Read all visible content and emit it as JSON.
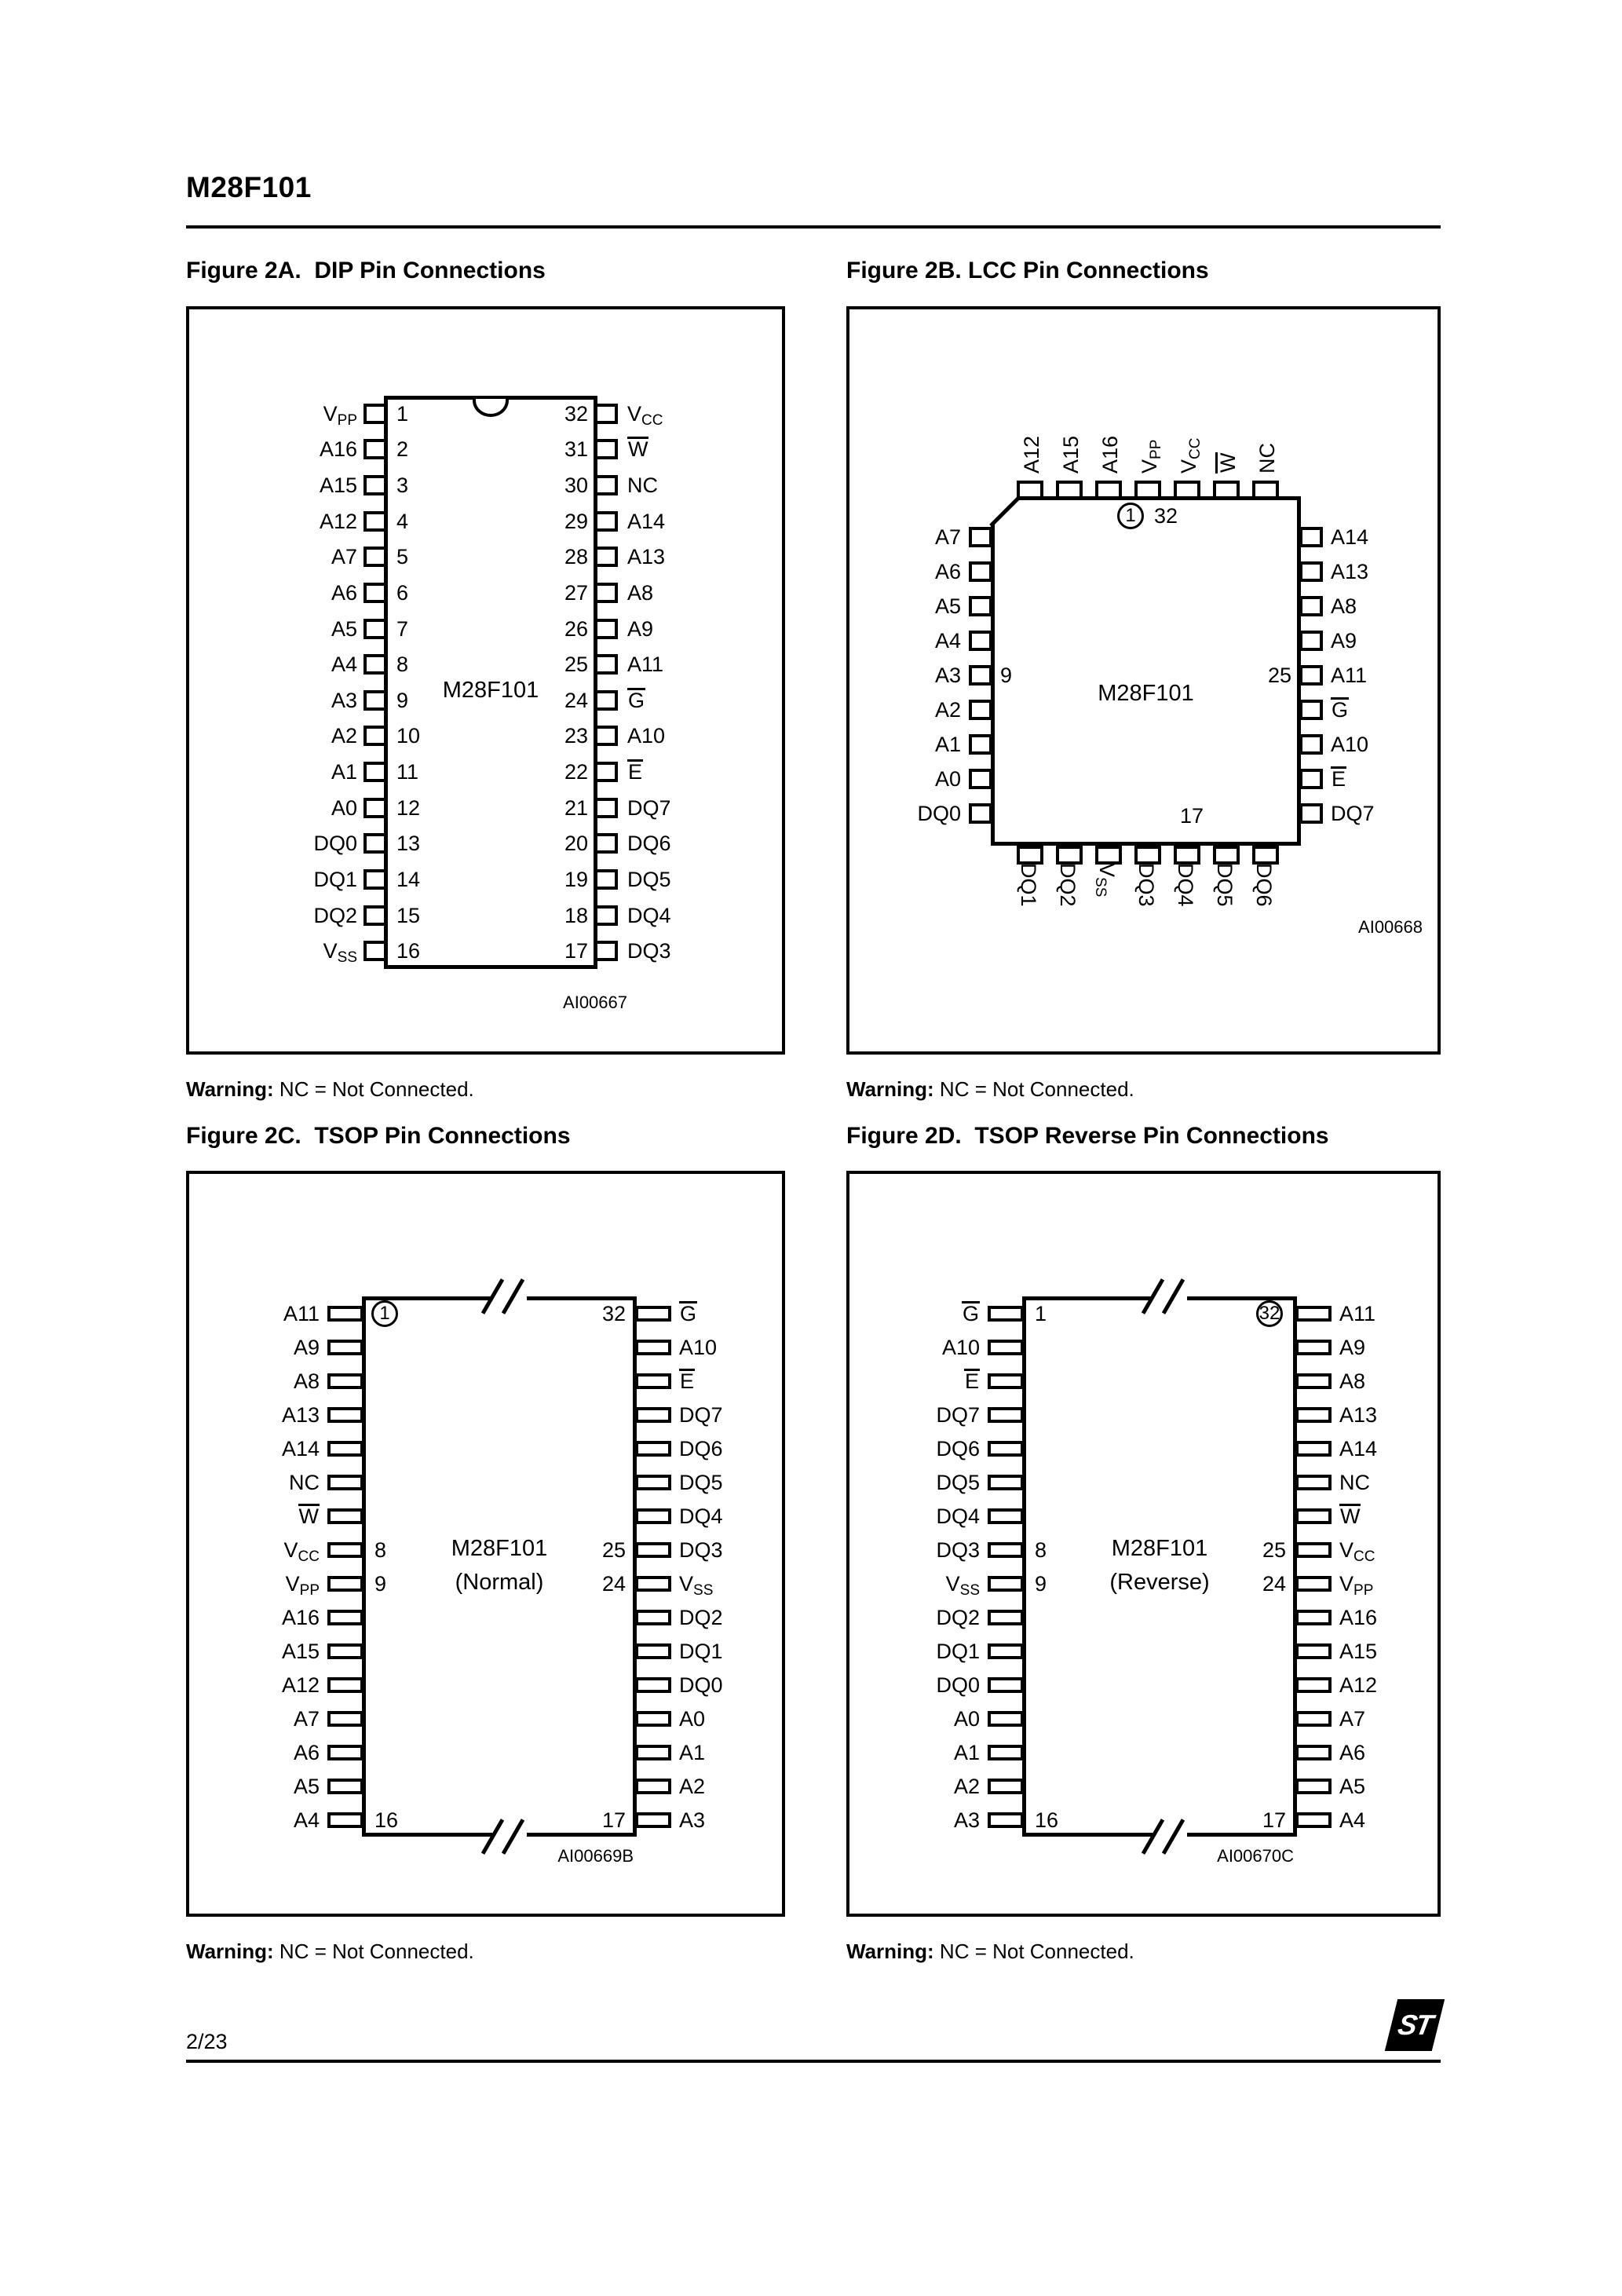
{
  "page": {
    "header_title": "M28F101",
    "page_number": "2/23",
    "logo_text": "ST"
  },
  "warning": {
    "label": "Warning:",
    "text": " NC = Not Connected."
  },
  "figures": {
    "dip": {
      "title": "Figure 2A.  DIP Pin Connections",
      "chip_name": "M28F101",
      "ref": "AI00667",
      "left": [
        {
          "b": "V",
          "s": "PP",
          "n": "1"
        },
        {
          "b": "A16",
          "n": "2"
        },
        {
          "b": "A15",
          "n": "3"
        },
        {
          "b": "A12",
          "n": "4"
        },
        {
          "b": "A7",
          "n": "5"
        },
        {
          "b": "A6",
          "n": "6"
        },
        {
          "b": "A5",
          "n": "7"
        },
        {
          "b": "A4",
          "n": "8"
        },
        {
          "b": "A3",
          "n": "9"
        },
        {
          "b": "A2",
          "n": "10"
        },
        {
          "b": "A1",
          "n": "11"
        },
        {
          "b": "A0",
          "n": "12"
        },
        {
          "b": "DQ0",
          "n": "13"
        },
        {
          "b": "DQ1",
          "n": "14"
        },
        {
          "b": "DQ2",
          "n": "15"
        },
        {
          "b": "V",
          "s": "SS",
          "n": "16"
        }
      ],
      "right": [
        {
          "b": "V",
          "s": "CC",
          "n": "32"
        },
        {
          "b": "W",
          "bar": true,
          "n": "31"
        },
        {
          "b": "NC",
          "n": "30"
        },
        {
          "b": "A14",
          "n": "29"
        },
        {
          "b": "A13",
          "n": "28"
        },
        {
          "b": "A8",
          "n": "27"
        },
        {
          "b": "A9",
          "n": "26"
        },
        {
          "b": "A11",
          "n": "25"
        },
        {
          "b": "G",
          "bar": true,
          "n": "24"
        },
        {
          "b": "A10",
          "n": "23"
        },
        {
          "b": "E",
          "bar": true,
          "n": "22"
        },
        {
          "b": "DQ7",
          "n": "21"
        },
        {
          "b": "DQ6",
          "n": "20"
        },
        {
          "b": "DQ5",
          "n": "19"
        },
        {
          "b": "DQ4",
          "n": "18"
        },
        {
          "b": "DQ3",
          "n": "17"
        }
      ]
    },
    "lcc": {
      "title": "Figure 2B. LCC Pin Connections",
      "chip_name": "M28F101",
      "ref": "AI00668",
      "top": [
        {
          "b": "A12"
        },
        {
          "b": "A15"
        },
        {
          "b": "A16"
        },
        {
          "b": "V",
          "s": "PP"
        },
        {
          "b": "V",
          "s": "CC"
        },
        {
          "b": "W",
          "bar": true
        },
        {
          "b": "NC"
        }
      ],
      "left": [
        {
          "b": "A7"
        },
        {
          "b": "A6"
        },
        {
          "b": "A5"
        },
        {
          "b": "A4"
        },
        {
          "b": "A3"
        },
        {
          "b": "A2"
        },
        {
          "b": "A1"
        },
        {
          "b": "A0"
        },
        {
          "b": "DQ0"
        }
      ],
      "right": [
        {
          "b": "A14"
        },
        {
          "b": "A13"
        },
        {
          "b": "A8"
        },
        {
          "b": "A9"
        },
        {
          "b": "A11"
        },
        {
          "b": "G",
          "bar": true
        },
        {
          "b": "A10"
        },
        {
          "b": "E",
          "bar": true
        },
        {
          "b": "DQ7"
        }
      ],
      "bottom": [
        {
          "b": "DQ1"
        },
        {
          "b": "DQ2"
        },
        {
          "b": "V",
          "s": "SS"
        },
        {
          "b": "DQ3"
        },
        {
          "b": "DQ4"
        },
        {
          "b": "DQ5"
        },
        {
          "b": "DQ6"
        }
      ],
      "pin1_marker": "1",
      "pin32_label": "32",
      "left_inner_num": {
        "text": "9",
        "row": 4
      },
      "right_inner_num": {
        "text": "25",
        "row": 4
      },
      "bottom_inner_num": "17"
    },
    "tsop": {
      "title": "Figure 2C.  TSOP Pin Connections",
      "chip_name": "M28F101",
      "variant": "(Normal)",
      "ref": "AI00669B",
      "left": [
        {
          "b": "A11",
          "n": "1",
          "c": true
        },
        {
          "b": "A9"
        },
        {
          "b": "A8"
        },
        {
          "b": "A13"
        },
        {
          "b": "A14"
        },
        {
          "b": "NC"
        },
        {
          "b": "W",
          "bar": true
        },
        {
          "b": "V",
          "s": "CC",
          "n": "8"
        },
        {
          "b": "V",
          "s": "PP",
          "n": "9"
        },
        {
          "b": "A16"
        },
        {
          "b": "A15"
        },
        {
          "b": "A12"
        },
        {
          "b": "A7"
        },
        {
          "b": "A6"
        },
        {
          "b": "A5"
        },
        {
          "b": "A4",
          "n": "16"
        }
      ],
      "right": [
        {
          "b": "G",
          "bar": true,
          "n": "32"
        },
        {
          "b": "A10"
        },
        {
          "b": "E",
          "bar": true
        },
        {
          "b": "DQ7"
        },
        {
          "b": "DQ6"
        },
        {
          "b": "DQ5"
        },
        {
          "b": "DQ4"
        },
        {
          "b": "DQ3",
          "n": "25"
        },
        {
          "b": "V",
          "s": "SS",
          "n": "24"
        },
        {
          "b": "DQ2"
        },
        {
          "b": "DQ1"
        },
        {
          "b": "DQ0"
        },
        {
          "b": "A0"
        },
        {
          "b": "A1"
        },
        {
          "b": "A2"
        },
        {
          "b": "A3",
          "n": "17"
        }
      ]
    },
    "tsop_reverse": {
      "title": "Figure 2D.  TSOP Reverse Pin Connections",
      "chip_name": "M28F101",
      "variant": "(Reverse)",
      "ref": "AI00670C",
      "left": [
        {
          "b": "G",
          "bar": true,
          "n": "1"
        },
        {
          "b": "A10"
        },
        {
          "b": "E",
          "bar": true
        },
        {
          "b": "DQ7"
        },
        {
          "b": "DQ6"
        },
        {
          "b": "DQ5"
        },
        {
          "b": "DQ4"
        },
        {
          "b": "DQ3",
          "n": "8"
        },
        {
          "b": "V",
          "s": "SS",
          "n": "9"
        },
        {
          "b": "DQ2"
        },
        {
          "b": "DQ1"
        },
        {
          "b": "DQ0"
        },
        {
          "b": "A0"
        },
        {
          "b": "A1"
        },
        {
          "b": "A2"
        },
        {
          "b": "A3",
          "n": "16"
        }
      ],
      "right": [
        {
          "b": "A11",
          "n": "32",
          "c": true
        },
        {
          "b": "A9"
        },
        {
          "b": "A8"
        },
        {
          "b": "A13"
        },
        {
          "b": "A14"
        },
        {
          "b": "NC"
        },
        {
          "b": "W",
          "bar": true
        },
        {
          "b": "V",
          "s": "CC",
          "n": "25"
        },
        {
          "b": "V",
          "s": "PP",
          "n": "24"
        },
        {
          "b": "A16"
        },
        {
          "b": "A15"
        },
        {
          "b": "A12"
        },
        {
          "b": "A7"
        },
        {
          "b": "A6"
        },
        {
          "b": "A5"
        },
        {
          "b": "A4",
          "n": "17"
        }
      ]
    }
  }
}
